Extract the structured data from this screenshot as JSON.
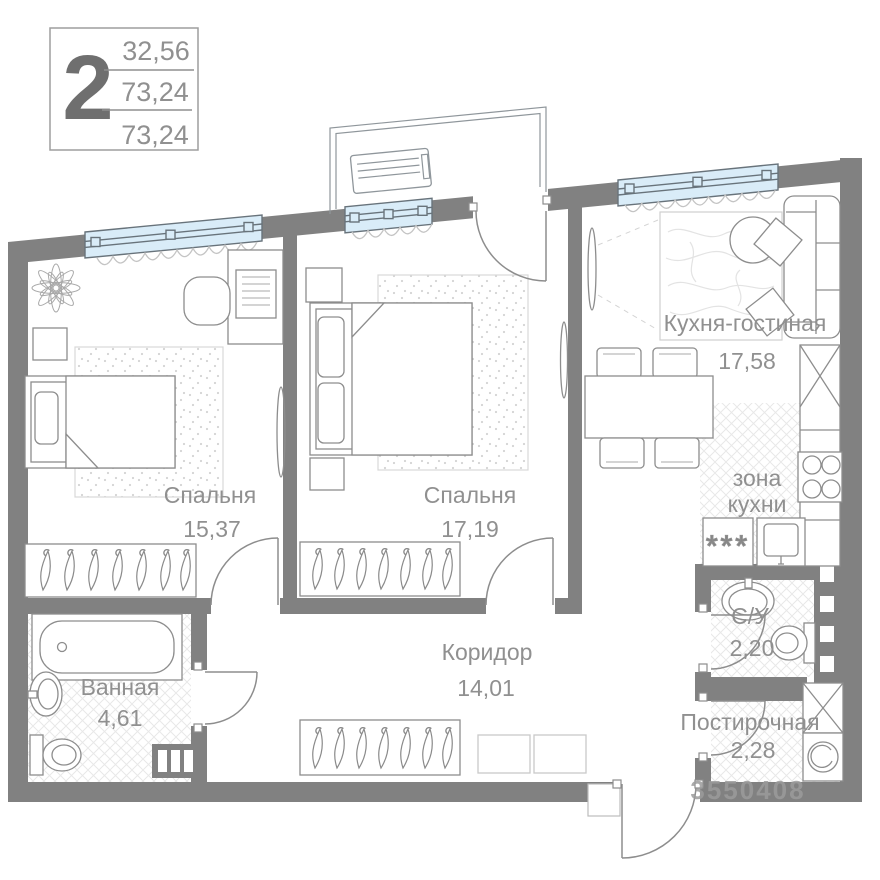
{
  "info_box": {
    "rooms_count": "2",
    "values": [
      "32,56",
      "73,24",
      "73,24"
    ]
  },
  "rooms": {
    "bedroom1": {
      "label": "Спальня",
      "area": "15,37"
    },
    "bedroom2": {
      "label": "Спальня",
      "area": "17,19"
    },
    "kitchen_living": {
      "label": "Кухня-гостиная",
      "area": "17,58"
    },
    "kitchen_zone": {
      "line1": "зона",
      "line2": "кухни"
    },
    "bathroom": {
      "label": "Ванная",
      "area": "4,61"
    },
    "wc": {
      "label": "С/У",
      "area": "2,20"
    },
    "corridor": {
      "label": "Коридор",
      "area": "14,01"
    },
    "laundry": {
      "label": "Постирочная",
      "area": "2,28"
    }
  },
  "appliance_symbol": "***",
  "watermark": "3550408",
  "colors": {
    "wall": "#818181",
    "window_glass": "#d9ecf8",
    "window_frame": "#68737b",
    "label_text": "#909090",
    "furniture_line": "#8d8d8d"
  }
}
